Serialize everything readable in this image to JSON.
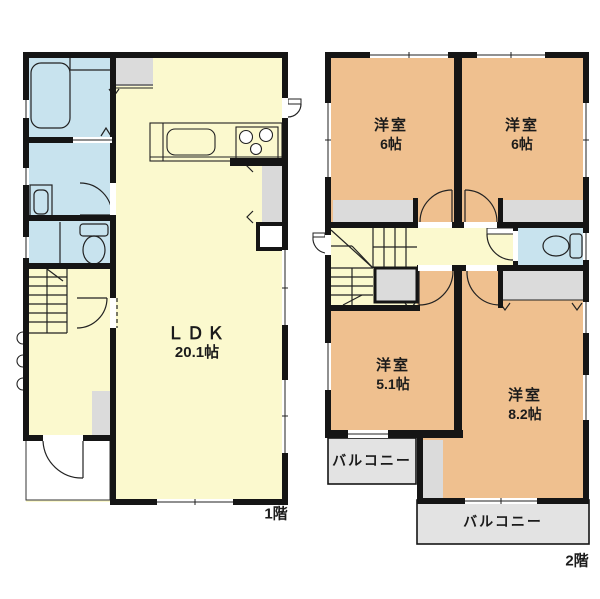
{
  "floor1": {
    "floor_label": "1階",
    "ldk": {
      "name": "ＬＤＫ",
      "size": "20.1帖"
    }
  },
  "floor2": {
    "floor_label": "2階",
    "room_nw": {
      "name": "洋室",
      "size": "6帖"
    },
    "room_ne": {
      "name": "洋室",
      "size": "6帖"
    },
    "room_sw": {
      "name": "洋室",
      "size": "5.1帖"
    },
    "room_se": {
      "name": "洋室",
      "size": "8.2帖"
    },
    "balcony_west": {
      "name": "バルコニー"
    },
    "balcony_south": {
      "name": "バルコニー"
    }
  },
  "colors": {
    "room_yellow": "#FBF9CE",
    "wet_room_blue": "#C8E3EE",
    "bedroom_orange": "#EFC08F",
    "closet_gray": "#DBDBDB",
    "balcony_gray": "#E3E3E3",
    "wall_black": "#151515",
    "line": "#222222"
  }
}
